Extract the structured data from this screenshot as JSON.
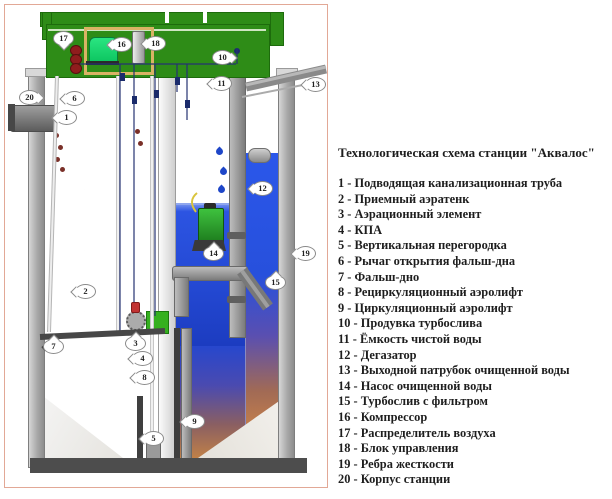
{
  "title": "Технологическая схема станции \"Аквалос\"",
  "legend_items": [
    {
      "text": "1 - Подводящая канализационная труба"
    },
    {
      "text": "2 - Приемный аэратенк"
    },
    {
      "text": "3 - Аэрационный элемент"
    },
    {
      "text": "4 - КПА"
    },
    {
      "text": "5 - Вертикальная перегородка"
    },
    {
      "text": "6 - Рычаг открытия фальш-дна"
    },
    {
      "text": "7 - Фальш-дно"
    },
    {
      "text": "8 - Рециркуляционный аэролифт"
    },
    {
      "text": "9 - Циркуляционный аэролифт"
    },
    {
      "text": "10 - Продувка турбослива"
    },
    {
      "text": "11 - Ёмкость чистой воды"
    },
    {
      "text": "12 - Дегазатор"
    },
    {
      "text": "13 - Выходной патрубок очищенной воды"
    },
    {
      "text": "14 - Насос очищенной воды"
    },
    {
      "text": "15 - Турбослив с фильтром"
    },
    {
      "text": "16 - Компрессор"
    },
    {
      "text": "17 - Распределитель воздуха"
    },
    {
      "text": "18 - Блок управления"
    },
    {
      "text": "19 - Ребра жесткости"
    },
    {
      "text": "20 - Корпус станции"
    }
  ],
  "callouts": [
    "1",
    "2",
    "3",
    "4",
    "5",
    "6",
    "7",
    "8",
    "9",
    "10",
    "11",
    "12",
    "13",
    "14",
    "15",
    "16",
    "17",
    "18",
    "19",
    "20"
  ],
  "colors": {
    "lid_green": "#2e8c17",
    "compressor_green": "#19d870",
    "machinery_bay_tan": "#d9b365",
    "valve_red": "#8f1d1d",
    "sludge_dark": "#5e2b24",
    "sludge_light": "#c49764",
    "water_blue": "#2348d2",
    "degasator_blue": "#2b57ea",
    "sediment_orange": "#c08048",
    "pipe_gray": "#8f8f8f",
    "base_gray": "#4d4d4d",
    "frame_border": "#e2a896"
  }
}
